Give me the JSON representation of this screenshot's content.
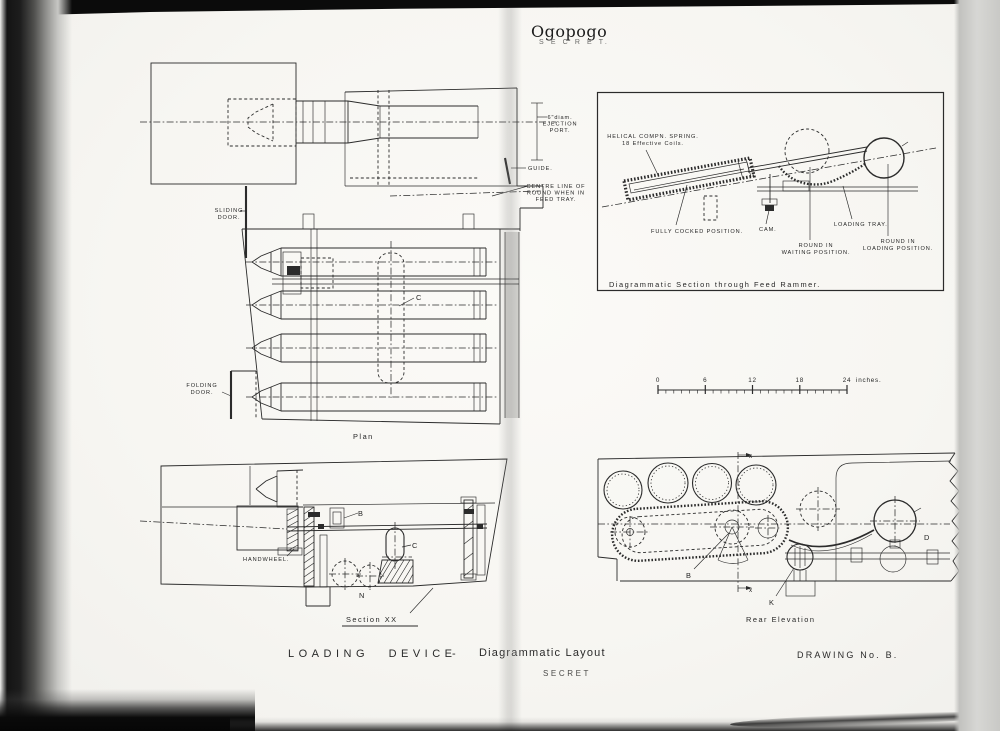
{
  "colors": {
    "paper": "#f8f7f3",
    "ink": "#2b2b2b",
    "stamp": "#6a6a68"
  },
  "header": {
    "title": "Ogopogo",
    "stamp": "S E C R E T."
  },
  "plan": {
    "caption": "Plan",
    "sliding_door": [
      "SLIDING",
      "DOOR."
    ],
    "folding_door": [
      "FOLDING",
      "DOOR."
    ],
    "ejection_port": [
      "6\"diam.",
      "EJECTION",
      "PORT."
    ],
    "guide": "GUIDE.",
    "centre_line": [
      "CENTRE LINE OF",
      "ROUND WHEN IN",
      "FEED TRAY."
    ],
    "label_c": "C"
  },
  "rammer": {
    "caption": "Diagrammatic Section through Feed Rammer.",
    "spring": [
      "HELICAL COMPN. SPRING.",
      "18 Effective Coils."
    ],
    "cocked": "FULLY COCKED POSITION.",
    "cam": "CAM.",
    "waiting": [
      "ROUND IN",
      "WAITING POSITION."
    ],
    "tray": "LOADING TRAY.",
    "loading": [
      "ROUND IN",
      "LOADING POSITION."
    ]
  },
  "scale_bar": {
    "ticks": [
      "0",
      "6",
      "12",
      "18",
      "24"
    ],
    "unit": "inches."
  },
  "section_xx": {
    "caption": "Section XX",
    "handwheel": "HANDWHEEL.",
    "label_b": "B",
    "label_c": "C",
    "label_n": "N"
  },
  "rear_elevation": {
    "caption": "Rear Elevation",
    "label_b": "B",
    "label_k": "K",
    "label_d": "D",
    "axis_top": "x",
    "axis_bottom": "x"
  },
  "footer": {
    "title_main": "LOADING DEVICE",
    "title_dash": "-",
    "title_sub": "Diagrammatic Layout",
    "stamp": "SECRET",
    "drawing_no": "DRAWING No. B."
  }
}
